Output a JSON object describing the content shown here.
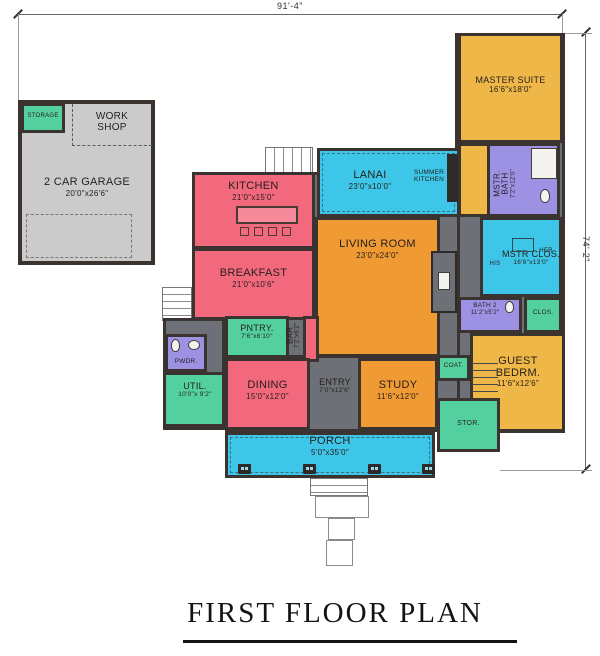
{
  "title": "FIRST FLOOR PLAN",
  "dimensions": {
    "top": "91'-4\"",
    "right": "74'-2\""
  },
  "rooms": {
    "storage": {
      "name": "STORAGE"
    },
    "workshop": {
      "name": "WORK SHOP"
    },
    "garage": {
      "name": "2 CAR GARAGE",
      "dims": "20'0\"x26'6\""
    },
    "kitchen": {
      "name": "KITCHEN",
      "dims": "21'0\"x15'0\""
    },
    "breakfast": {
      "name": "BREAKFAST",
      "dims": "21'0\"x10'6\""
    },
    "lanai": {
      "name": "LANAI",
      "dims": "23'0\"x10'0\""
    },
    "summer_kitchen": {
      "name": "SUMMER KITCHEN"
    },
    "living_room": {
      "name": "LIVING ROOM",
      "dims": "23'0\"x24'0\""
    },
    "master_suite": {
      "name": "MASTER SUITE",
      "dims": "16'6\"x18'0\""
    },
    "master_bath": {
      "name": "MSTR. BATH",
      "dims": "7'2\"x12'0\""
    },
    "master_closet": {
      "name": "MSTR CLOS.",
      "dims": "16'6\"x13'0\"",
      "his": "HIS",
      "her": "HER"
    },
    "bath2": {
      "name": "BATH 2",
      "dims": "11'2\"x5'2\""
    },
    "closet": {
      "name": "CLOS."
    },
    "guest_bedroom": {
      "name": "GUEST BEDRM.",
      "dims": "11'6\"x12'6\""
    },
    "entry": {
      "name": "ENTRY",
      "dims": "7'0\"x12'6\""
    },
    "study": {
      "name": "STUDY",
      "dims": "11'6\"x12'0\""
    },
    "coat": {
      "name": "COAT."
    },
    "storage_closet": {
      "name": "STOR."
    },
    "porch": {
      "name": "PORCH",
      "dims": "5'0\"x35'0\""
    },
    "dining": {
      "name": "DINING",
      "dims": "15'0\"x12'0\""
    },
    "pantry": {
      "name": "PNTRY.",
      "dims": "7'6\"x6'10\""
    },
    "bar": {
      "name": "BAR",
      "dims": "7'2\"x6'2\""
    },
    "powder": {
      "name": "PWDR."
    },
    "utility": {
      "name": "UTIL.",
      "dims": "10'0\"x 9'2\""
    }
  },
  "palette": {
    "bedrooms_gold": "#efb747",
    "living_orange": "#f09a33",
    "kitchen_pink": "#f2697e",
    "outdoor_cyan": "#3ec6e8",
    "bath_purple": "#9c91e3",
    "storage_green": "#54d0a0",
    "hall_gray": "#6d7076",
    "garage_gray": "#cbcbcb",
    "wall": "#3a332f"
  }
}
